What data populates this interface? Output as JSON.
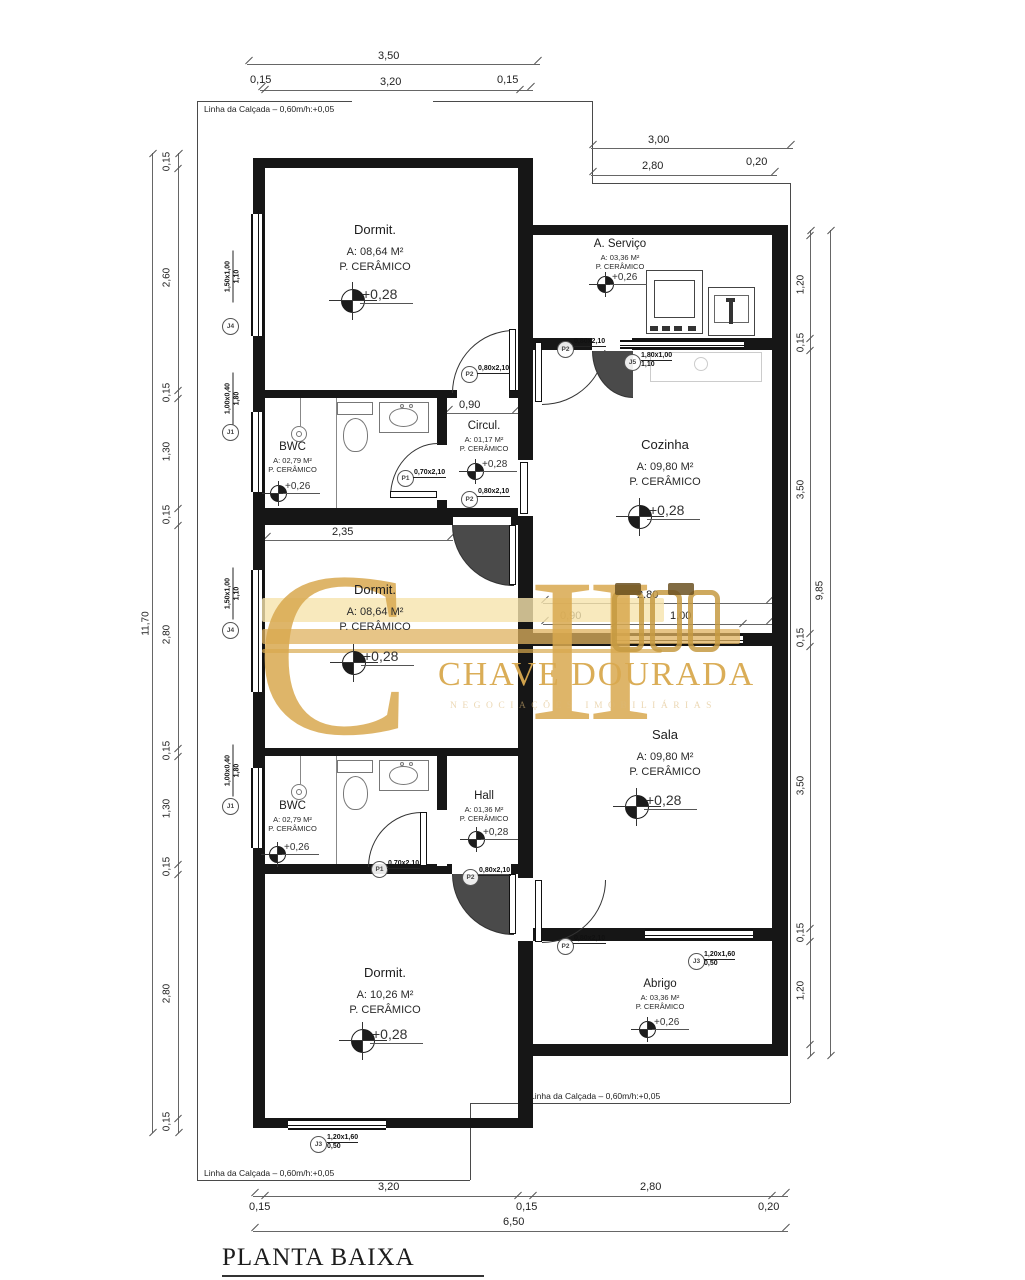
{
  "title": {
    "text": "PLANTA BAIXA",
    "scale": "ESCALA 1:50"
  },
  "boundary_label": "Linha da Calçada  –  0,60m/h:+0,05",
  "watermark": {
    "monogram_c": "C",
    "monogram_stem": "I",
    "name": "CHAVE DOURADA",
    "subtitle": "NEGOCIAÇÕES IMOBILIÁRIAS",
    "gold": "#d9a94f"
  },
  "rooms": {
    "dormit1": {
      "name": "Dormit.",
      "area": "A: 08,64 M²",
      "floor": "P. CERÂMICO",
      "level": "+0,28"
    },
    "bwc1": {
      "name": "BWC",
      "area": "A: 02,79 M²",
      "floor": "P. CERÂMICO",
      "level": "+0,26"
    },
    "circul": {
      "name": "Circul.",
      "area": "A: 01,17 M²",
      "floor": "P. CERÂMICO",
      "level": "+0,28"
    },
    "servico": {
      "name": "A. Serviço",
      "area": "A: 03,36 M²",
      "floor": "P. CERÂMICO",
      "level": "+0,26"
    },
    "cozinha": {
      "name": "Cozinha",
      "area": "A: 09,80 M²",
      "floor": "P. CERÂMICO",
      "level": "+0,28"
    },
    "dormit2": {
      "name": "Dormit.",
      "area": "A: 08,64 M²",
      "floor": "P. CERÂMICO",
      "level": "+0,28"
    },
    "sala": {
      "name": "Sala",
      "area": "A: 09,80 M²",
      "floor": "P. CERÂMICO",
      "level": "+0,28"
    },
    "bwc2": {
      "name": "BWC",
      "area": "A: 02,79 M²",
      "floor": "P. CERÂMICO",
      "level": "+0,26"
    },
    "hall": {
      "name": "Hall",
      "area": "A: 01,36 M²",
      "floor": "P. CERÂMICO",
      "level": "+0,28"
    },
    "dormit3": {
      "name": "Dormit.",
      "area": "A: 10,26 M²",
      "floor": "P. CERÂMICO",
      "level": "+0,28"
    },
    "abrigo": {
      "name": "Abrigo",
      "area": "A: 03,36 M²",
      "floor": "P. CERÂMICO",
      "level": "+0,26"
    }
  },
  "doors": {
    "p1": {
      "tag": "P1",
      "size": "0,70x2,10"
    },
    "p2": {
      "tag": "P2",
      "size": "0,80x2,10"
    }
  },
  "windows": {
    "j1": {
      "tag": "J1",
      "size": "1,00x0,40",
      "sill": "1,80"
    },
    "j3": {
      "tag": "J3",
      "size": "1,20x1,60",
      "sill": "0,50"
    },
    "j4": {
      "tag": "J4",
      "size": "1,50x1,00",
      "sill": "1,10"
    },
    "j5": {
      "tag": "J5",
      "size": "1,80x1,00",
      "sill": "1,10"
    }
  },
  "dims": {
    "top": {
      "overall": "3,50",
      "left": "0,15",
      "inner": "3,20",
      "right": "0,15"
    },
    "top_right": {
      "overall": "3,00",
      "inner": "2,80",
      "wall": "0,20"
    },
    "left": {
      "overall": "11,70",
      "segments": [
        "0,15",
        "2,60",
        "0,15",
        "1,30",
        "0,15",
        "2,80",
        "0,15",
        "1,30",
        "0,15",
        "2,80",
        "0,15"
      ]
    },
    "right": {
      "overall": "9,85",
      "segments": [
        "1,20",
        "0,15",
        "3,50",
        "0,15",
        "3,50",
        "0,15",
        "1,20"
      ]
    },
    "bottom": {
      "overall": "6,50",
      "left_wall": "0,15",
      "left_span": "3,20",
      "mid_wall": "0,15",
      "right_span": "2,80",
      "right_wall": "0,20"
    },
    "interior": {
      "circul": "0,90",
      "dormit2": "2,35",
      "kitchen_span": "2,80",
      "kitchen_left": "0,90",
      "kitchen_pass": "1,00"
    }
  }
}
